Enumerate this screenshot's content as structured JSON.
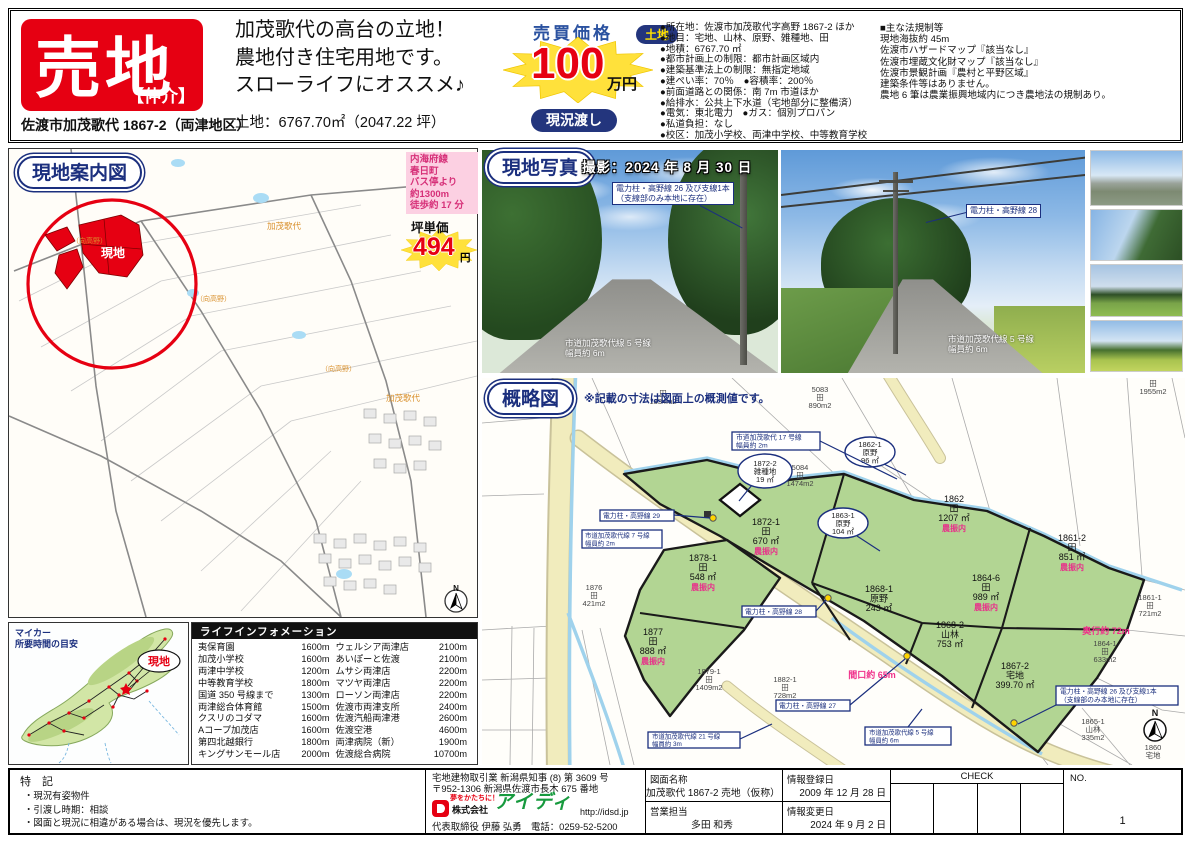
{
  "header": {
    "sale_badge": "売地",
    "brokerage": "【仲介】",
    "address_line": "佐渡市加茂歌代 1867-2（両津地区）",
    "catch_lines": [
      "加茂歌代の高台の立地！",
      "農地付き住宅用地です。",
      "スローライフにオススメ♪"
    ],
    "land_area_line": "土地：6767.70㎡（2047.22 坪）",
    "price_label": "売買価格",
    "price_value": "100",
    "price_unit": "万円",
    "delivery_badge": "現況渡し",
    "land_badge": "土地",
    "land_details": [
      "●所在地：佐渡市加茂歌代字高野 1867-2 ほか",
      "●地目：宅地、山林、原野、雑種地、田",
      "●地積：6767.70 ㎡",
      "●都市計画上の制限：都市計画区域内",
      "●建築基準法上の制限：無指定地域",
      "●建ぺい率：70％　●容積率：200％",
      "●前面道路との関係：南 7m 市道ほか",
      "●給排水：公共上下水道（宅地部分に整備済）",
      "●電気：東北電力　●ガス：個別プロパン",
      "●私道負担：なし",
      "●校区：加茂小学校、両津中学校、中等教育学校"
    ],
    "regulations_title": "■主な法規制等",
    "regulations": [
      "現地海抜約 45m",
      "佐渡市ハザードマップ『該当なし』",
      "佐渡市埋蔵文化財マップ『該当なし』",
      "佐渡市景観計画『農村と平野区域』",
      "建築条件等はありません。",
      "農地 6 筆は農業振興地域内につき農地法の規制あり。"
    ]
  },
  "guide_map": {
    "title": "現地案内図",
    "bus_lines": [
      "内海府線",
      "春日町",
      "バス停より",
      "約1300m",
      "徒歩約 17 分"
    ],
    "tsubo_label": "坪単価",
    "tsubo_value": "494",
    "tsubo_unit": "円",
    "site_label": "現地",
    "area_label_1": "加茂歌代",
    "area_label_2": "（向高野）",
    "area_label_3": "加茂歌代",
    "compass": "N"
  },
  "car_map": {
    "title_line1": "マイカー",
    "title_line2": "所要時間の目安",
    "site_label": "現地"
  },
  "life_info": {
    "title": "ライフインフォメーション",
    "rows_left": [
      [
        "夷保育園",
        "1600m"
      ],
      [
        "加茂小学校",
        "1600m"
      ],
      [
        "両津中学校",
        "1200m"
      ],
      [
        "中等教育学校",
        "1800m"
      ],
      [
        "国道 350 号線まで",
        "1300m"
      ],
      [
        "両津総合体育館",
        "1500m"
      ],
      [
        "クスリのコダマ",
        "1600m"
      ],
      [
        "Aコープ加茂店",
        "1600m"
      ],
      [
        "第四北越銀行",
        "1800m"
      ],
      [
        "キングサンモール店",
        "2000m"
      ]
    ],
    "rows_right": [
      [
        "ウェルシア両津店",
        "2100m"
      ],
      [
        "あいぽーと佐渡",
        "2100m"
      ],
      [
        "ムサシ両津店",
        "2200m"
      ],
      [
        "マツヤ両津店",
        "2200m"
      ],
      [
        "ローソン両津店",
        "2200m"
      ],
      [
        "佐渡市両津支所",
        "2400m"
      ],
      [
        "佐渡汽船両津港",
        "2600m"
      ],
      [
        "佐渡空港",
        "4600m"
      ],
      [
        "両津病院（新）",
        "1900m"
      ],
      [
        "佐渡総合病院",
        "10700m"
      ]
    ]
  },
  "photos": {
    "title": "現地写真",
    "shot_date": "撮影：2024 年 8 月 30 日",
    "p1_label_line1": "電力柱・高野線 26 及び支線1本",
    "p1_label_line2": "（支線部のみ本地に存在）",
    "p1_road": "市道加茂歌代線 5 号線",
    "p1_road2": "幅員約 6m",
    "p2_label": "電力柱・高野線 28",
    "p2_road": "市道加茂歌代線 5 号線",
    "p2_road2": "幅員約 6m"
  },
  "sketch": {
    "title": "概略図",
    "note": "※記載の寸法は図面上の概測値です。",
    "farm_tag": "農振内",
    "parcels": {
      "p1872_1": {
        "id": "1872-1",
        "type": "田",
        "area": "670 ㎡"
      },
      "p1862": {
        "id": "1862",
        "type": "田",
        "area": "1207 ㎡"
      },
      "p1861_2": {
        "id": "1861-2",
        "type": "田",
        "area": "851 ㎡"
      },
      "p1864_6": {
        "id": "1864-6",
        "type": "田",
        "area": "989 ㎡"
      },
      "p1868_1": {
        "id": "1868-1",
        "type": "原野",
        "area": "243 ㎡"
      },
      "p1868_2": {
        "id": "1868-2",
        "type": "山林",
        "area": "753 ㎡"
      },
      "p1867_2": {
        "id": "1867-2",
        "type": "宅地",
        "area": "399.70 ㎡"
      },
      "p1878_1": {
        "id": "1878-1",
        "type": "田",
        "area": "548 ㎡"
      },
      "p1877": {
        "id": "1877",
        "type": "田",
        "area": "888 ㎡"
      },
      "c1872_2": {
        "id": "1872-2",
        "type": "雑種地",
        "area": "19 ㎡"
      },
      "c1862_1": {
        "id": "1862-1",
        "type": "原野",
        "area": "96 ㎡"
      },
      "c1863_1": {
        "id": "1863-1",
        "type": "原野",
        "area": "104 ㎡"
      }
    },
    "neighbors": {
      "n1334": {
        "id": "",
        "type": "田",
        "area": "1334m2"
      },
      "n5083": {
        "id": "5083",
        "type": "田",
        "area": "890m2"
      },
      "n5084": {
        "id": "5084",
        "type": "田",
        "area": "1474m2"
      },
      "n1955": {
        "id": "",
        "type": "田",
        "area": "1955m2"
      },
      "n1861_1": {
        "id": "1861-1",
        "type": "田",
        "area": "721m2"
      },
      "n1864_1": {
        "id": "1864-1",
        "type": "田",
        "area": "633m2"
      },
      "n1865_1": {
        "id": "1865-1",
        "type": "山林",
        "area": "335m2"
      },
      "n1860": {
        "id": "1860",
        "type": "宅地",
        "area": ""
      },
      "n1879_1": {
        "id": "1879-1",
        "type": "田",
        "area": "1409m2"
      },
      "n1882_1": {
        "id": "1882-1",
        "type": "田",
        "area": "728m2"
      },
      "n1876": {
        "id": "1876",
        "type": "田",
        "area": "421m2"
      }
    },
    "roads": {
      "r17": {
        "line1": "市道加茂歌代 17 号線",
        "line2": "幅員約 2m"
      },
      "r7": {
        "line1": "市道加茂歌代線 7 号線",
        "line2": "幅員約 2m"
      },
      "r5": {
        "line1": "市道加茂歌代線 5 号線",
        "line2": "幅員約 6m"
      },
      "r21": {
        "line1": "市道加茂歌代線 21 号線",
        "line2": "幅員約 3m"
      }
    },
    "poles": {
      "p29": "電力柱・高野線 29",
      "p28": "電力柱・高野線 28",
      "p27": "電力柱・高野線 27",
      "p26_line1": "電力柱・高野線 26 及び支線1本",
      "p26_line2": "（支線部のみ本地に存在）"
    },
    "dims": {
      "frontage": "間口約 65m",
      "depth": "奥行約 72m"
    },
    "compass": "N"
  },
  "footer": {
    "notes_title": "特 記",
    "notes": [
      "・現況有姿物件",
      "・引渡し時期：相談",
      "・図面と現況に相違がある場合は、現況を優先します。"
    ],
    "license_line1": "宅地建物取引業 新潟県知事 (8) 第 3609 号",
    "license_line2": "〒952-1306 新潟県佐渡市長木 675 番地",
    "company_tagline": "夢をかたちに！",
    "company_prefix": "株式会社",
    "company_name": "アイディ",
    "company_url": "http://idsd.jp",
    "representative": "代表取締役 伊藤 弘勇",
    "phone": "電話：0259-52-5200",
    "drawing_label": "図面名称",
    "drawing_name": "加茂歌代 1867-2 売地（仮称）",
    "sales_label": "営業担当",
    "sales_person": "多田 和秀",
    "registered_label": "情報登録日",
    "registered_date": "2009 年 12 月 28 日",
    "modified_label": "情報変更日",
    "modified_date": "2024 年 9 月 2 日",
    "check_label": "CHECK",
    "no_label": "NO.",
    "no_value": "1"
  }
}
